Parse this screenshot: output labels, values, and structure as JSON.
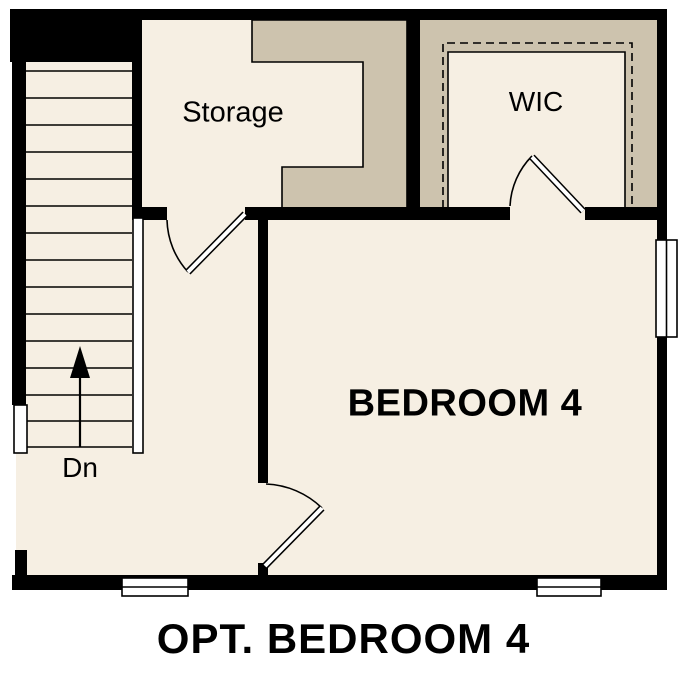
{
  "caption": "OPT. BEDROOM 4",
  "rooms": {
    "storage": {
      "label": "Storage"
    },
    "wic": {
      "label": "WIC"
    },
    "bedroom": {
      "label": "BEDROOM 4"
    }
  },
  "stairs": {
    "label": "Dn",
    "direction_icon": "up-arrow-icon"
  },
  "colors": {
    "floor": "#f6efe3",
    "closet_tan": "#cdc3ae",
    "wall": "#000000",
    "background": "#ffffff"
  }
}
